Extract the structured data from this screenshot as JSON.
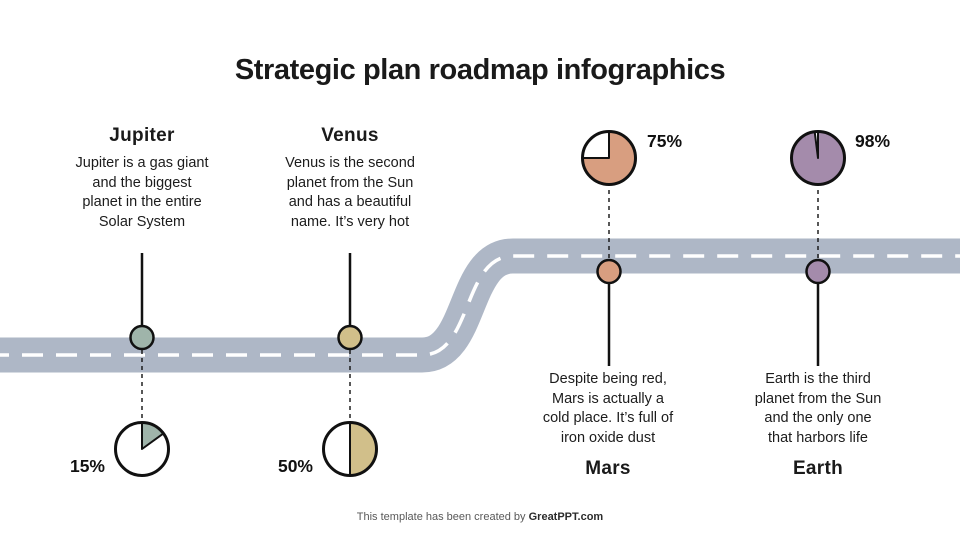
{
  "title": "Strategic plan roadmap infographics",
  "footer": {
    "prefix": "This template has been created by ",
    "brand": "GreatPPT.com"
  },
  "colors": {
    "road": "#aeb7c6",
    "road_center_line": "#ffffff",
    "stroke_ink": "#111111"
  },
  "planets": [
    {
      "name": "Jupiter",
      "description": "Jupiter is a gas giant\nand the biggest\nplanet in the entire\nSolar System",
      "percent": 15,
      "percent_label": "15%",
      "color": "#9fb4aa",
      "pie_side": "bottom"
    },
    {
      "name": "Venus",
      "description": "Venus is the second\nplanet from the Sun\nand has a beautiful\nname. It’s very hot",
      "percent": 50,
      "percent_label": "50%",
      "color": "#d1bf8a",
      "pie_side": "bottom"
    },
    {
      "name": "Mars",
      "description": "Despite being red,\nMars is actually a\ncold place. It’s full of\niron oxide dust",
      "percent": 75,
      "percent_label": "75%",
      "color": "#d89e80",
      "pie_side": "top"
    },
    {
      "name": "Earth",
      "description": "Earth is the third\nplanet from the Sun\nand the only one\nthat harbors life",
      "percent": 98,
      "percent_label": "98%",
      "color": "#a48bab",
      "pie_side": "top"
    }
  ],
  "chart_data": [
    {
      "type": "pie",
      "title": "Jupiter progress",
      "labels": [
        "complete",
        "remaining"
      ],
      "values": [
        15,
        85
      ],
      "colors": [
        "#9fb4aa",
        "#ffffff"
      ]
    },
    {
      "type": "pie",
      "title": "Venus progress",
      "labels": [
        "complete",
        "remaining"
      ],
      "values": [
        50,
        50
      ],
      "colors": [
        "#d1bf8a",
        "#ffffff"
      ]
    },
    {
      "type": "pie",
      "title": "Mars progress",
      "labels": [
        "complete",
        "remaining"
      ],
      "values": [
        75,
        25
      ],
      "colors": [
        "#d89e80",
        "#ffffff"
      ]
    },
    {
      "type": "pie",
      "title": "Earth progress",
      "labels": [
        "complete",
        "remaining"
      ],
      "values": [
        98,
        2
      ],
      "colors": [
        "#a48bab",
        "#ffffff"
      ]
    }
  ]
}
